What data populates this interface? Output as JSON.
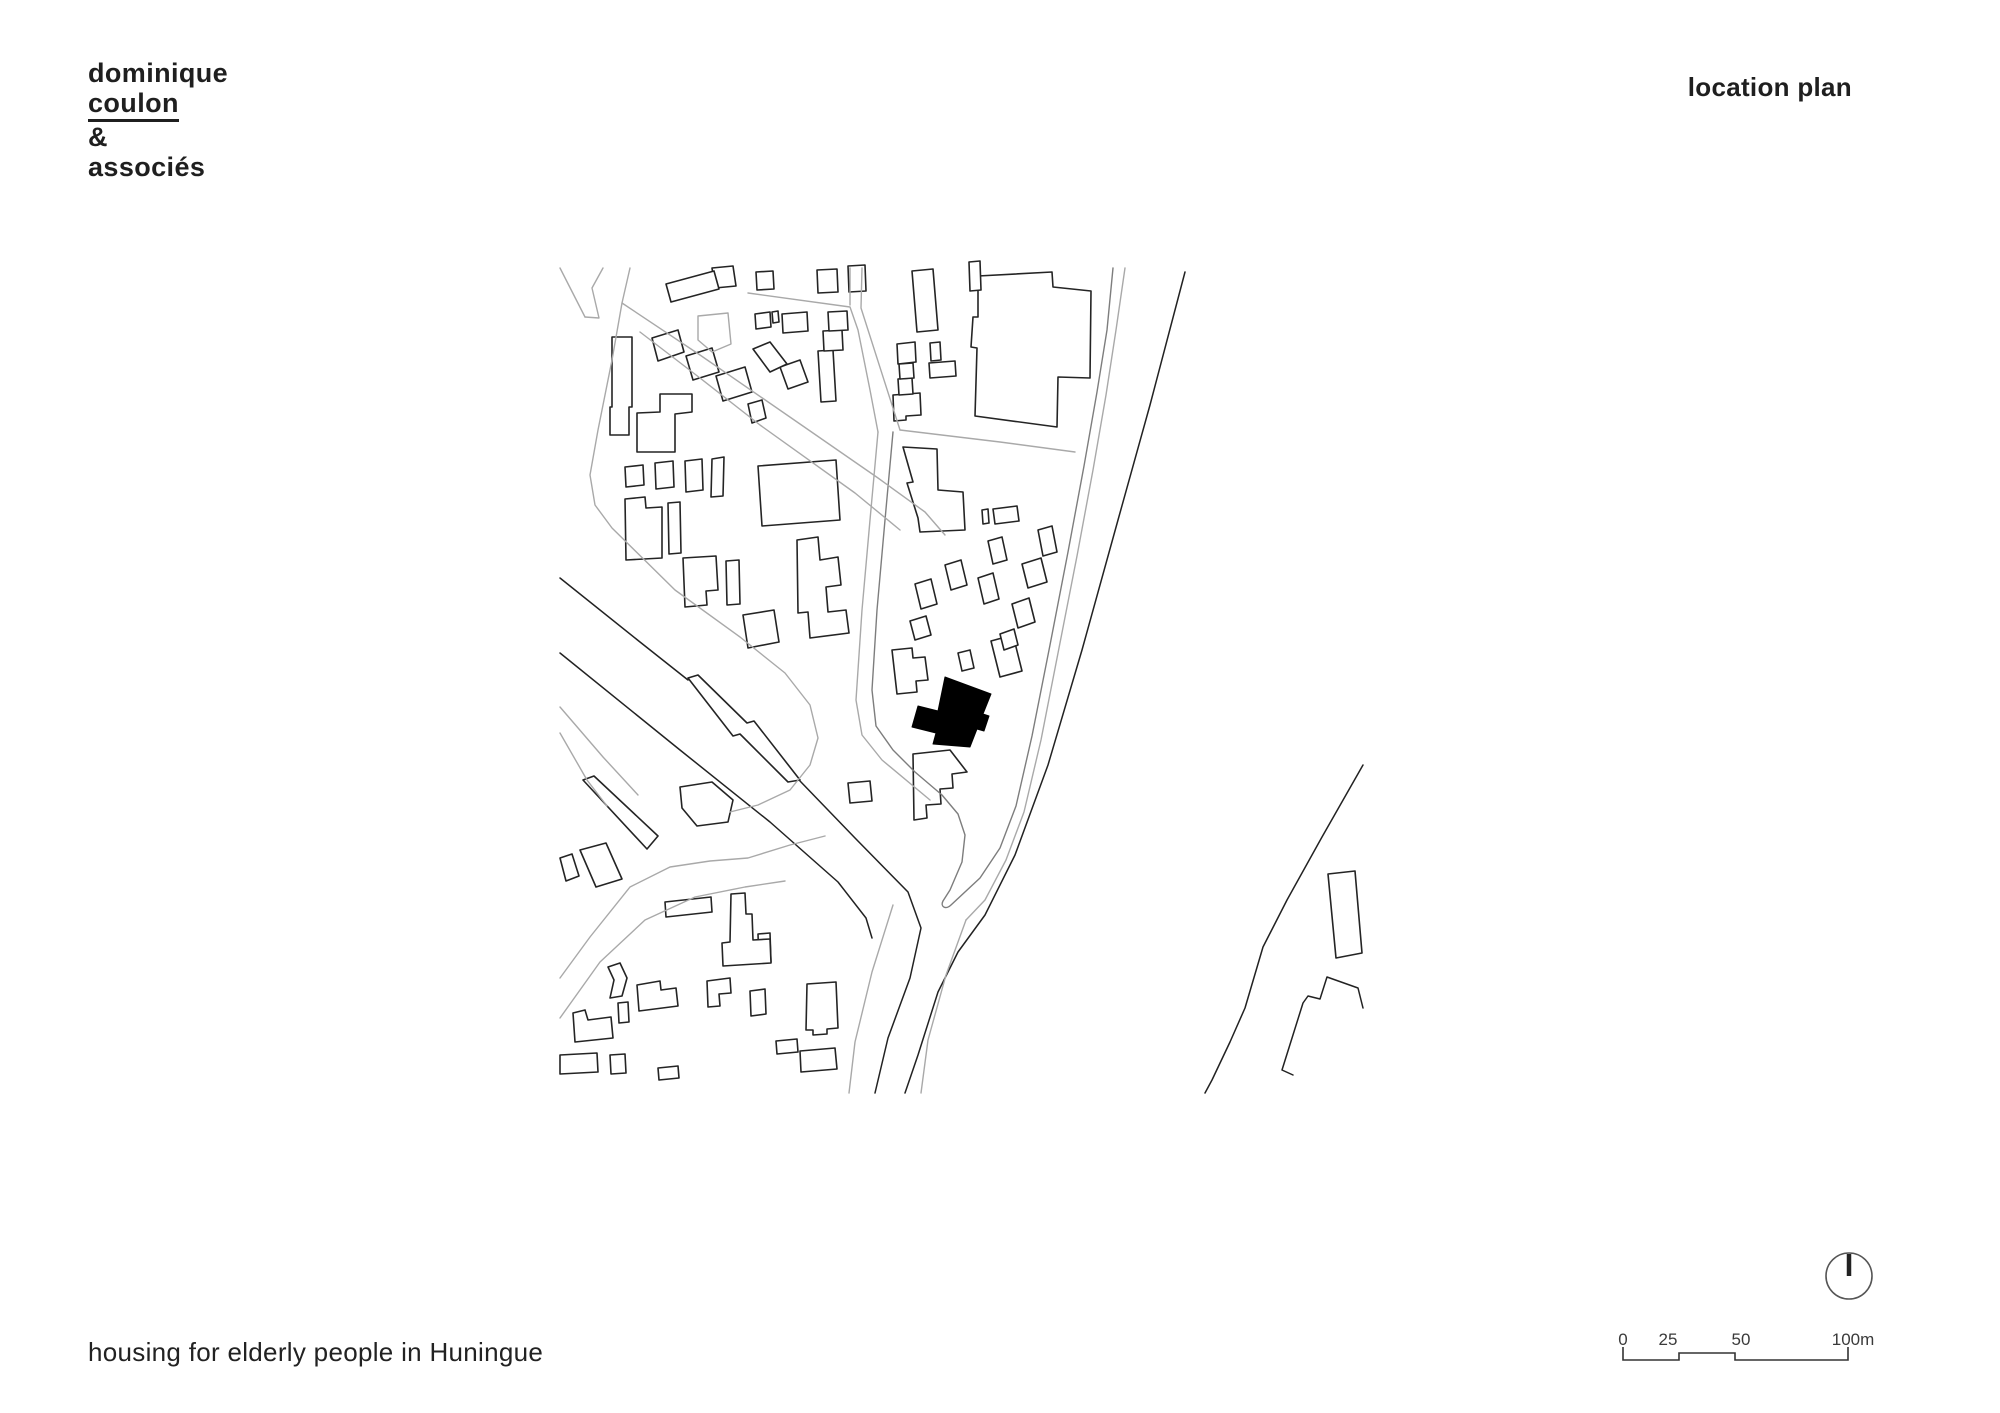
{
  "header": {
    "brand_line1": "dominique",
    "brand_line2": "coulon",
    "brand_line3": "&",
    "brand_line4": "associés",
    "sheet_title": "location plan"
  },
  "footer": {
    "project_title": "housing for elderly people in Huningue"
  },
  "scale_bar": {
    "labels": [
      "0",
      "25",
      "50",
      "100m"
    ],
    "path": "M1623,1347 L1623,1360 L1679,1360 L1679,1353 L1735,1353 L1735,1360 L1848,1360 L1848,1347"
  },
  "north_indicator": {
    "needle_path": "M1849,1254 L1849,1276"
  },
  "colors": {
    "background": "#ffffff",
    "text": "#1f1f1f",
    "street_gray": "#a9a9a9",
    "block_outline_gray": "#7d7d7d",
    "building_stroke": "#242424",
    "dark_line": "#222222",
    "site_building_fill": "#000000"
  },
  "map": {
    "description": "site location plan of Huningue: streets, building footprints, railway corridor, Rhine river bank; project building filled black",
    "layers": [
      {
        "name": "street-line",
        "stroke": "#a9a9a9",
        "width": 1.4,
        "fill": "none",
        "paths": [
          "M560,268 L585,317",
          "M603,268 L592,288 L599,318 L585,317",
          "M630,268 L622,303 L612,360 L598,430 L590,475 L595,505 L612,528 L675,590 L740,637 L785,673 L810,705 L818,738 L810,765 L790,790 L758,805 L730,812",
          "M622,303 L700,355 L800,424 L878,478 L925,512 L945,535",
          "M640,332 L700,378 L760,425 L855,493 L900,530",
          "M878,432 L870,520 L862,610 L856,700 L862,735 L882,760 L930,800",
          "M900,430 L1000,442 L1075,452",
          "M748,293 L850,307 L858,330 L870,390 L878,432",
          "M850,268 L850,305",
          "M862,268 L861,308 L900,430",
          "M698,316 L728,313 L731,344 L712,352 L698,340 Z",
          "M560,978 L590,937 L630,887 L670,867 L710,861 L748,858 L790,845 L825,836",
          "M560,1018 L600,962 L645,920 L695,897 L745,887 L785,881",
          "M560,707 L603,757 L638,795",
          "M560,733 L587,780 L607,806",
          "M893,905 L872,972 L855,1042 L849,1093",
          "M966,920 L946,975 L928,1040 L921,1093",
          "M1125,268 L1116,330 L1106,395 L1093,470 L1077,556 L1059,648 L1041,740 L1024,812 L1006,860 L985,900 L966,920"
        ]
      },
      {
        "name": "site-block-outline",
        "stroke": "#7d7d7d",
        "width": 1.4,
        "fill": "none",
        "paths": [
          "M893,432 L885,520 L877,610 L872,690 L876,726 L893,750 L915,772 L942,795 L958,814 L965,835 L962,862 L950,890 L943,901 C940,907 946,910 951,905 L980,878 L1000,848 L1016,806 L1032,736 L1050,645 L1068,552 L1084,466 L1097,392 L1107,330 L1113,268"
        ]
      },
      {
        "name": "railway-line",
        "stroke": "#222222",
        "width": 1.5,
        "fill": "none",
        "paths": [
          "M560,578 L640,642 L688,680",
          "M800,781 L855,838 L908,892 L921,928 L910,978 L888,1038 L875,1093",
          "M560,653 L680,750 L770,822 L838,882 L866,918 L872,938"
        ]
      },
      {
        "name": "river-bank-line",
        "stroke": "#222222",
        "width": 1.5,
        "fill": "none",
        "paths": [
          "M1185,272 L1150,405 L1118,520 L1082,650 L1048,765 L1015,855 L985,915 L958,952 L938,992 L918,1055 L905,1093",
          "M1363,765 L1322,837 L1287,900 L1263,947 L1245,1008 L1230,1042 L1212,1080 L1205,1093",
          "M1363,1008 L1358,988 L1327,977 L1320,999 L1308,996 L1303,1003 L1282,1070 L1293,1075"
        ]
      },
      {
        "name": "building-footprint",
        "stroke": "#242424",
        "width": 1.6,
        "fill": "#ffffff",
        "paths": [
          "M666,284 L714,271 L719,289 L671,302 Z",
          "M712,268 L733,266 L736,286 L715,288 Z",
          "M756,272 L773,271 L774,289 L757,290 Z",
          "M817,270 L837,269 L838,292 L818,293 Z",
          "M848,266 L865,265 L866,291 L849,292 Z",
          "M969,262 L980,261 L981,290 L970,291 Z",
          "M652,338 L678,330 L684,352 L658,361 Z",
          "M686,356 L712,348 L719,372 L693,380 Z",
          "M716,376 L745,367 L752,392 L723,401 Z",
          "M748,404 L762,400 L766,418 L752,423 Z",
          "M612,337 L632,337 L632,407 L629,407 L629,435 L610,435 L610,407 L612,407 Z",
          "M660,394 L692,394 L692,412 L675,414 L675,452 L637,452 L637,413 L660,412 Z",
          "M625,467 L643,465 L644,485 L626,487 Z",
          "M655,463 L673,461 L674,487 L656,489 Z",
          "M685,461 L702,459 L703,490 L686,492 Z",
          "M712,459 L724,457 L723,496 L711,497 Z",
          "M758,466 L836,460 L840,520 L762,526 Z",
          "M625,499 L645,497 L646,508 L662,507 L662,558 L626,560 Z",
          "M668,503 L680,502 L681,553 L669,554 Z",
          "M683,558 L716,556 L718,590 L706,591 L707,605 L685,607 Z",
          "M726,561 L739,560 L740,604 L727,605 Z",
          "M743,615 L774,610 L779,642 L748,648 Z",
          "M797,540 L818,537 L820,560 L838,557 L841,585 L826,587 L828,612 L846,610 L849,633 L810,638 L808,612 L798,613 Z",
          "M755,314 L770,312 L771,327 L756,329 Z",
          "M772,312 L778,311 L779,322 L773,323 Z",
          "M782,314 L807,312 L808,331 L783,333 Z",
          "M828,312 L847,311 L848,330 L829,331 Z",
          "M823,331 L842,330 L843,350 L824,351 Z",
          "M818,351 L833,350 L836,401 L821,402 Z",
          "M753,349 L770,342 L787,364 L770,372 Z",
          "M780,367 L800,360 L808,382 L788,389 Z",
          "M912,271 L933,269 L938,330 L917,332 Z",
          "M978,276 L1052,272 L1053,287 L1091,291 L1090,378 L1058,377 L1057,427 L975,416 L977,348 L971,347 L973,317 L978,317 Z",
          "M897,344 L915,342 L916,362 L898,364 Z",
          "M899,364 L913,363 L914,378 L900,379 Z",
          "M898,379 L912,378 L913,394 L899,395 Z",
          "M893,395 L920,393 L921,415 L906,416 L906,420 L894,421 Z",
          "M930,343 L940,342 L941,360 L931,361 Z",
          "M929,363 L955,361 L956,376 L930,378 Z",
          "M903,447 L937,449 L938,490 L963,492 L965,530 L920,532 L918,518 L907,483 L913,482 Z",
          "M982,510 L988,509 L989,523 L983,524 Z",
          "M993,509 L1017,506 L1019,521 L995,524 Z",
          "M1038,530 L1052,526 L1057,552 L1043,556 Z",
          "M988,541 L1002,537 L1007,560 L993,564 Z",
          "M1022,564 L1041,558 L1047,582 L1028,588 Z",
          "M978,578 L993,573 L999,599 L984,604 Z",
          "M1012,604 L1029,598 L1035,622 L1018,628 Z",
          "M945,565 L961,560 L967,585 L951,590 Z",
          "M915,584 L931,579 L937,604 L921,609 Z",
          "M910,621 L926,616 L931,635 L915,640 Z",
          "M1000,634 L1014,629 L1018,645 L1004,650 Z",
          "M892,650 L912,648 L913,658 L925,657 L928,680 L916,681 L917,692 L897,694 Z",
          "M958,653 L970,650 L974,668 L962,671 Z",
          "M991,641 L1013,635 L1022,671 L1000,677 Z",
          "M913,754 L950,750 L967,772 L952,774 L953,788 L940,789 L941,804 L926,805 L927,818 L914,820 Z",
          "M848,783 L870,781 L872,801 L850,803 Z",
          "M680,787 L712,782 L733,800 L728,822 L697,826 L682,808 Z",
          "M583,780 L594,776 L658,836 L647,849 Z",
          "M580,850 L606,843 L622,879 L596,887 Z",
          "M560,858 L572,854 L579,876 L566,881 Z",
          "M688,678 L698,675 L747,723 L754,721 L800,780 L788,782 L740,734 L733,736 Z",
          "M665,902 L711,897 L712,912 L666,917 Z",
          "M731,894 L745,893 L746,914 L752,914 L753,940 L770,939 L771,963 L723,966 L722,943 L730,942 Z",
          "M758,934 L770,933 L771,962 L759,963 Z",
          "M707,981 L730,978 L731,993 L719,994 L720,1006 L708,1007 Z",
          "M750,991 L765,989 L766,1014 L751,1016 Z",
          "M807,984 L836,982 L838,1028 L827,1029 L827,1034 L813,1035 L813,1030 L806,1030 Z",
          "M608,967 L620,963 L627,978 L622,996 L610,998 L614,980 Z",
          "M637,985 L660,981 L661,990 L676,988 L678,1006 L639,1011 Z",
          "M618,1003 L628,1002 L629,1022 L619,1023 Z",
          "M573,1013 L585,1010 L588,1020 L611,1017 L613,1038 L575,1042 Z",
          "M560,1055 L597,1053 L598,1072 L560,1074 Z",
          "M610,1055 L625,1054 L626,1073 L611,1074 Z",
          "M658,1068 L678,1066 L679,1078 L659,1080 Z",
          "M776,1041 L797,1039 L798,1052 L777,1054 Z",
          "M800,1051 L835,1048 L837,1069 L801,1072 Z",
          "M1328,874 L1355,871 L1362,953 L1336,958 Z"
        ]
      },
      {
        "name": "site-building",
        "stroke": "#000000",
        "width": 1,
        "fill": "#000000",
        "paths": [
          "M945,677 L991,694 L983,714 L989,716 L984,731 L977,729 L970,747 L933,744 L936,733 L912,727 L918,706 L938,711 Z"
        ]
      }
    ]
  }
}
